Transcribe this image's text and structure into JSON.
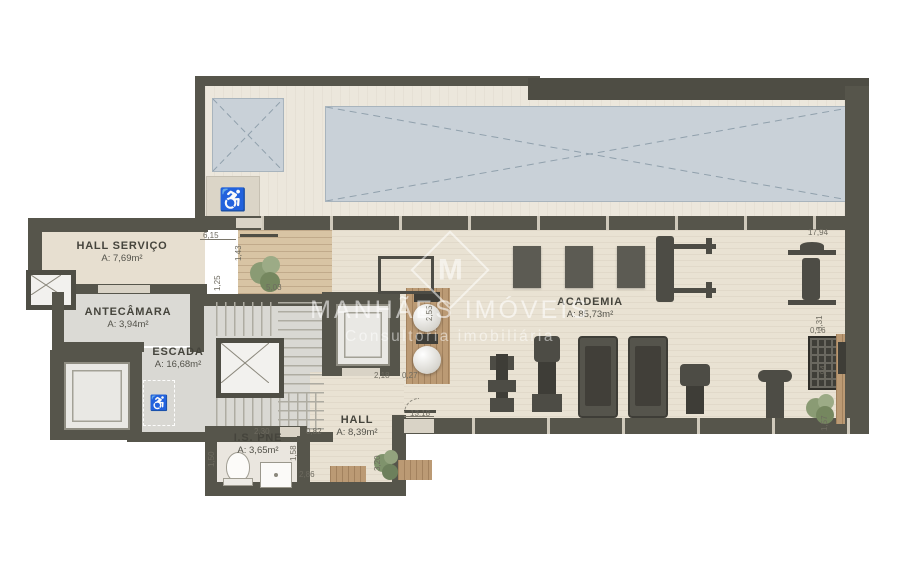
{
  "watermark": {
    "brand": "MANHÃES IMÓVEIS",
    "tagline": "Consultoria imobiliária",
    "logo_letter": "M"
  },
  "icons": {
    "wheelchair": "♿"
  },
  "rooms": [
    {
      "name": "HALL SERVIÇO",
      "area": "A: 7,69m²"
    },
    {
      "name": "ANTECÂMARA",
      "area": "A: 3,94m²"
    },
    {
      "name": "ESCADA",
      "area": "A: 16,68m²"
    },
    {
      "name": "I.S. PNE",
      "area": "A: 3,65m²"
    },
    {
      "name": "HALL",
      "area": "A: 8,39m²"
    },
    {
      "name": "ACADEMIA",
      "area": "A: 85,73m²"
    }
  ],
  "dimensions": [
    {
      "value": "6,15"
    },
    {
      "value": "1,43"
    },
    {
      "value": "1,25"
    },
    {
      "value": "5,03"
    },
    {
      "value": "2,55"
    },
    {
      "value": "2,18"
    },
    {
      "value": "0,27"
    },
    {
      "value": "13,18"
    },
    {
      "value": "0,82"
    },
    {
      "value": "1,58"
    },
    {
      "value": "2,30"
    },
    {
      "value": "1,50"
    },
    {
      "value": "2,86"
    },
    {
      "value": "3,20"
    },
    {
      "value": "17,94"
    },
    {
      "value": "3,31"
    },
    {
      "value": "0,16"
    },
    {
      "value": "1,94"
    },
    {
      "value": "1,57"
    }
  ],
  "colors": {
    "wall": "#56554b",
    "floor_wood": "#e9e2d3",
    "floor_gray": "#d9d8d3",
    "skylight": "#c9d1d8",
    "deck_wood": "#d8c4a4",
    "equipment": "#4d4c45"
  }
}
